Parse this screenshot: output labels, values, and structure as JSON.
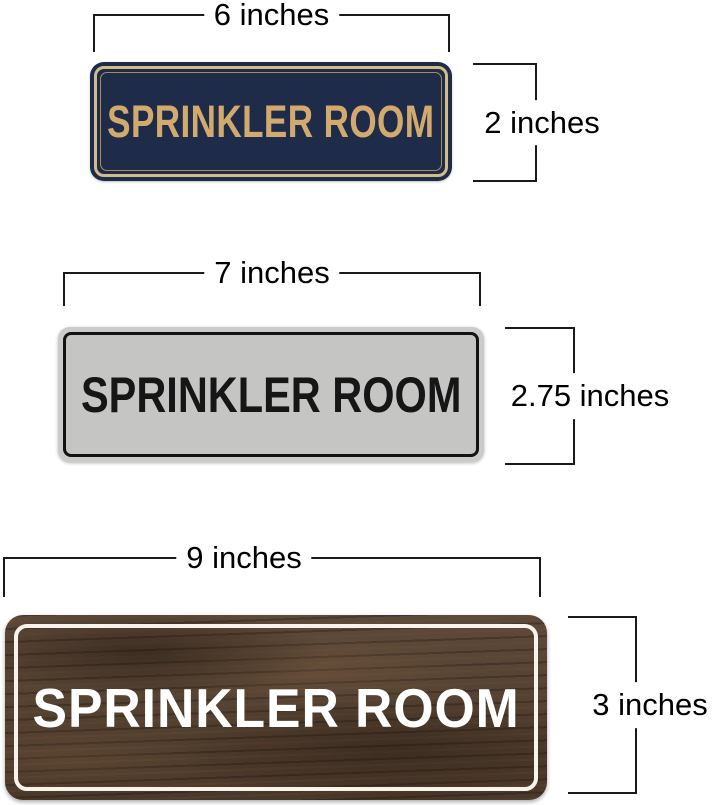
{
  "page": {
    "background": "#ffffff"
  },
  "dimensions": {
    "line_color": "#1a1a1a",
    "label_color": "#000000"
  },
  "figures": [
    {
      "name": "navy-blue-sign",
      "sign_text": "SPRINKLER ROOM",
      "width_label": "6 inches",
      "height_label": "2 inches",
      "colors": {
        "bg": "#1f2c49",
        "text": "#d2aa6e",
        "border_outer": "#d2bc8a",
        "border_inner": "#a98c55"
      }
    },
    {
      "name": "silver-sign",
      "sign_text": "SPRINKLER ROOM",
      "width_label": "7 inches",
      "height_label": "2.75 inches",
      "colors": {
        "bg": "#cbcbc9",
        "inner_bg": "#c5c5c3",
        "text": "#161616",
        "border": "#131313"
      }
    },
    {
      "name": "walnut-wood-sign",
      "sign_text": "SPRINKLER ROOM",
      "width_label": "9 inches",
      "height_label": "3 inches",
      "colors": {
        "bg": "#54402f",
        "text": "#ffffff",
        "border": "#f7f3ea"
      }
    }
  ]
}
